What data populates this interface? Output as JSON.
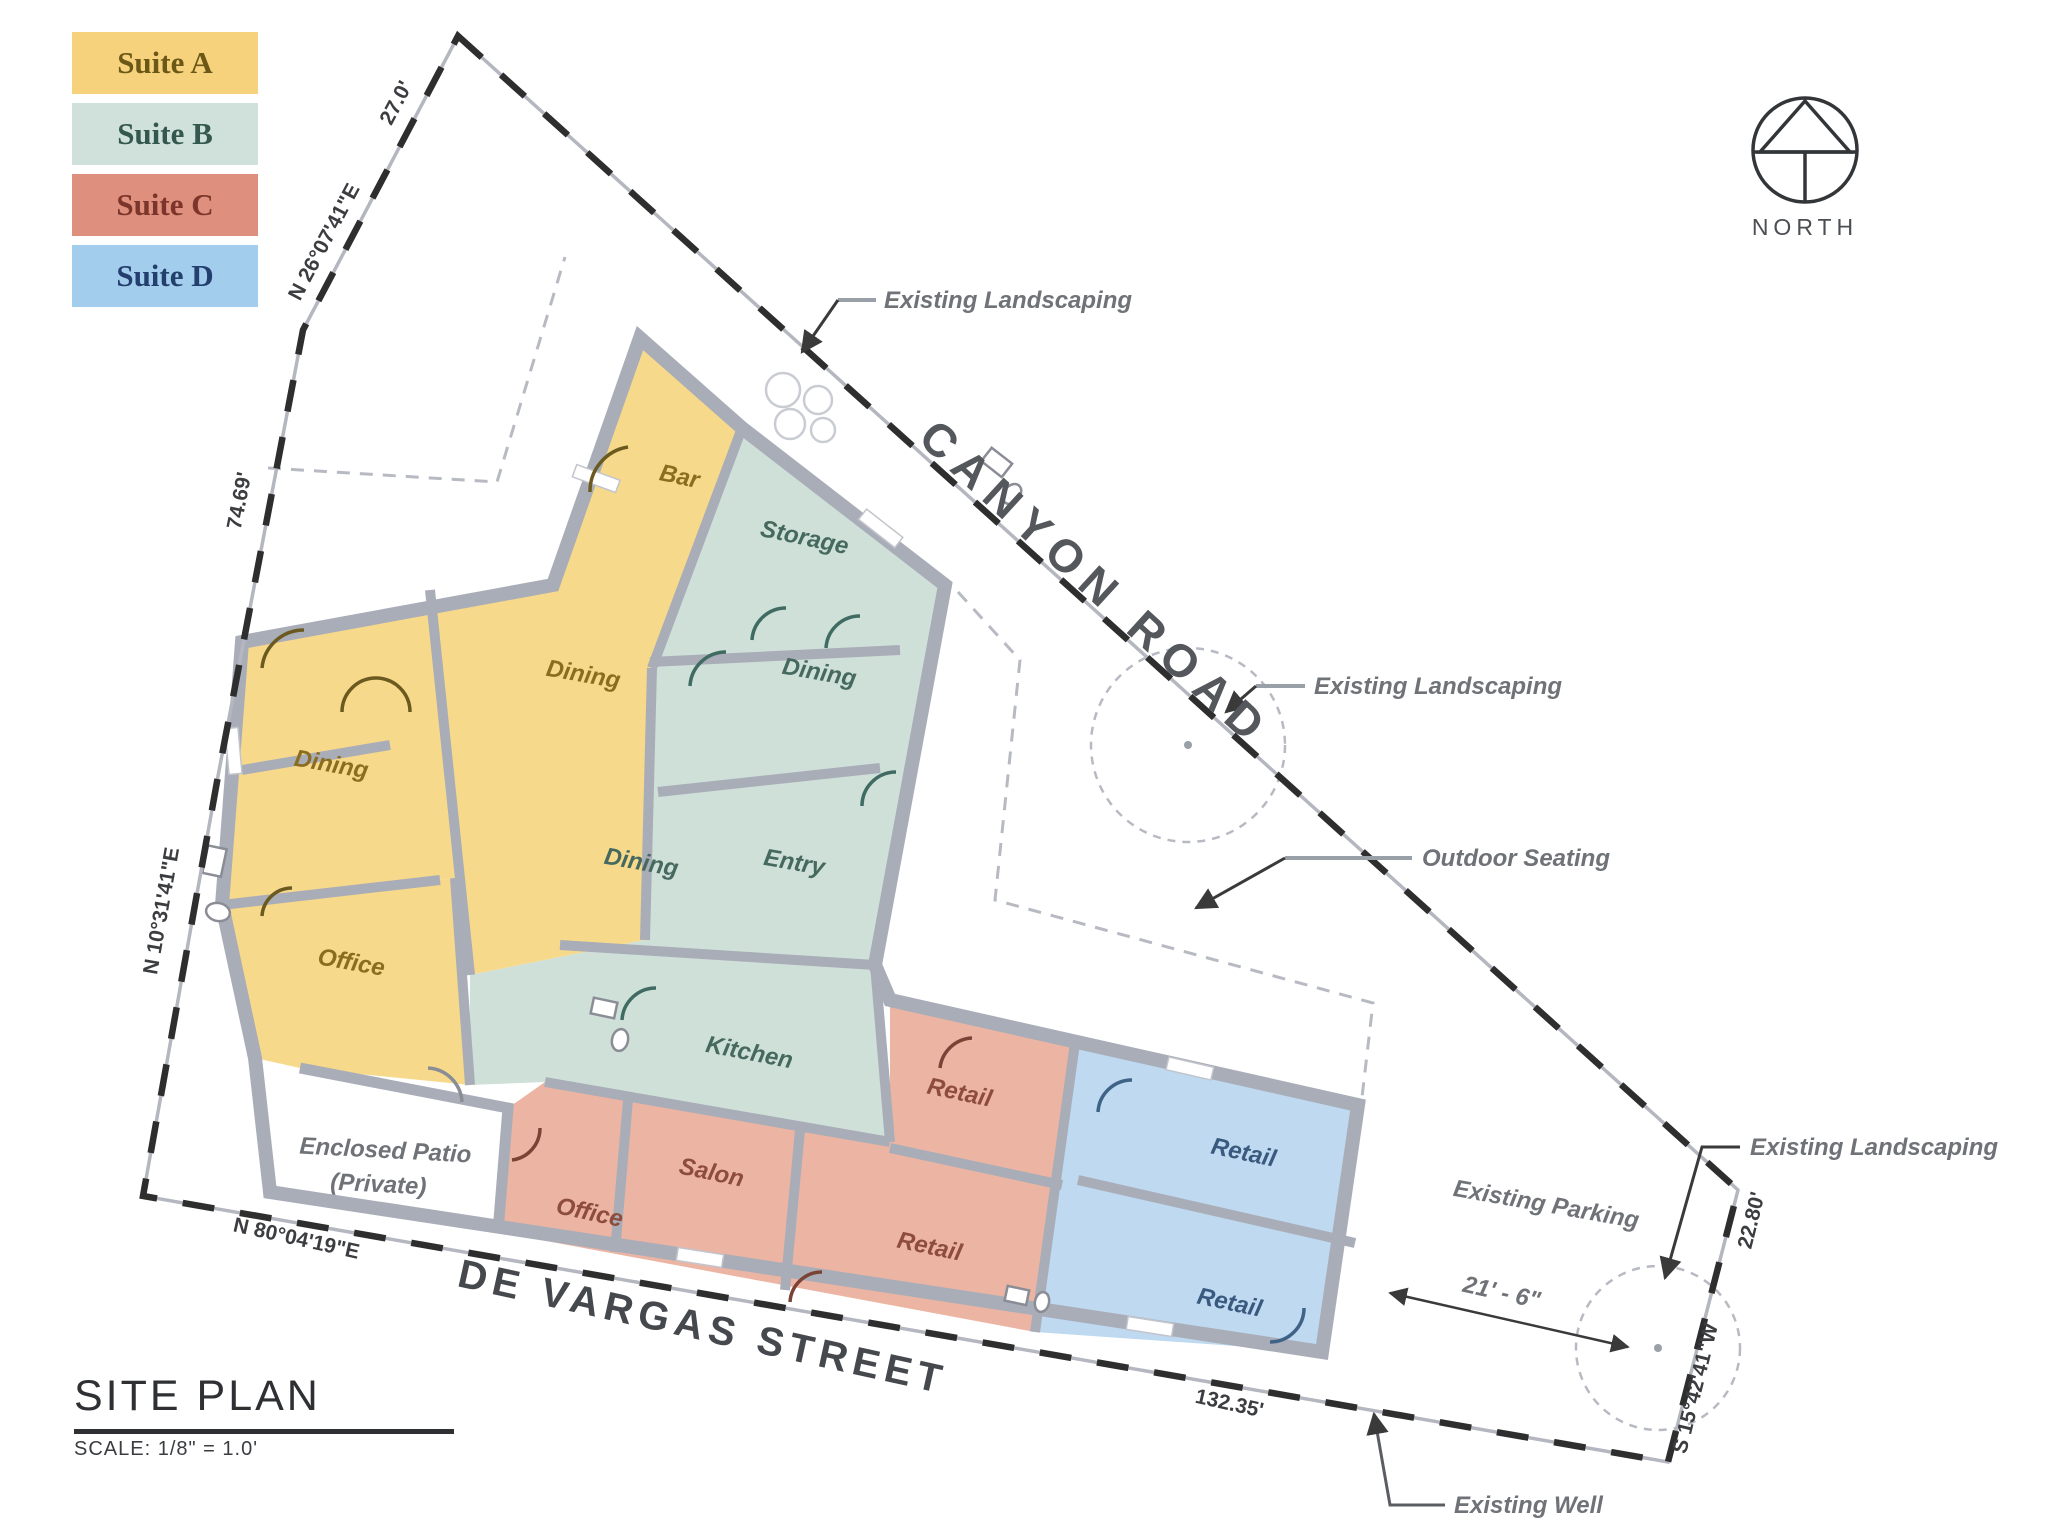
{
  "colors": {
    "suite_a_fill": "#f7d98b",
    "suite_b_fill": "#cfe0d8",
    "suite_c_fill": "#ecb5a3",
    "suite_d_fill": "#bed9f0",
    "legend_a": "#f6d27d",
    "legend_b": "#cfe1da",
    "legend_c": "#df8f7d",
    "legend_d": "#a3cdec",
    "wall": "#a9adb8",
    "boundary": "#2e2e2e"
  },
  "legend": {
    "items": [
      {
        "label": "Suite A"
      },
      {
        "label": "Suite B"
      },
      {
        "label": "Suite C"
      },
      {
        "label": "Suite D"
      }
    ]
  },
  "north": {
    "label": "NORTH"
  },
  "title": {
    "heading": "SITE PLAN",
    "scale": "SCALE: 1/8\" = 1.0'"
  },
  "streets": {
    "canyon": "CANYON ROAD",
    "devargas": "DE VARGAS STREET"
  },
  "boundary": {
    "bearing_ne": "N 26°07'41\"E",
    "len_ne": "27.0'",
    "len_w_upper": "74.69'",
    "bearing_w_lower": "N 10°31'41\"E",
    "bearing_s": "N 80°04'19\"E",
    "len_s": "132.35'",
    "bearing_e": "S 15°42'41\"W",
    "len_e": "22.80'"
  },
  "rooms": {
    "dining_a_main": "Dining",
    "dining_a_mid": "Dining",
    "bar": "Bar",
    "office_a": "Office",
    "storage": "Storage",
    "dining_b_upper": "Dining",
    "dining_b_lower": "Dining",
    "entry": "Entry",
    "kitchen": "Kitchen",
    "retail_c_upper": "Retail",
    "salon": "Salon",
    "office_c": "Office",
    "retail_c_lower": "Retail",
    "retail_d_upper": "Retail",
    "retail_d_lower": "Retail"
  },
  "site": {
    "patio_line1": "Enclosed Patio",
    "patio_line2": "(Private)",
    "parking": "Existing Parking"
  },
  "annotations": {
    "landscaping_top": "Existing Landscaping",
    "landscaping_mid": "Existing Landscaping",
    "landscaping_right": "Existing Landscaping",
    "outdoor_seating": "Outdoor Seating",
    "well": "Existing Well",
    "dim_21_6": "21' - 6\""
  }
}
